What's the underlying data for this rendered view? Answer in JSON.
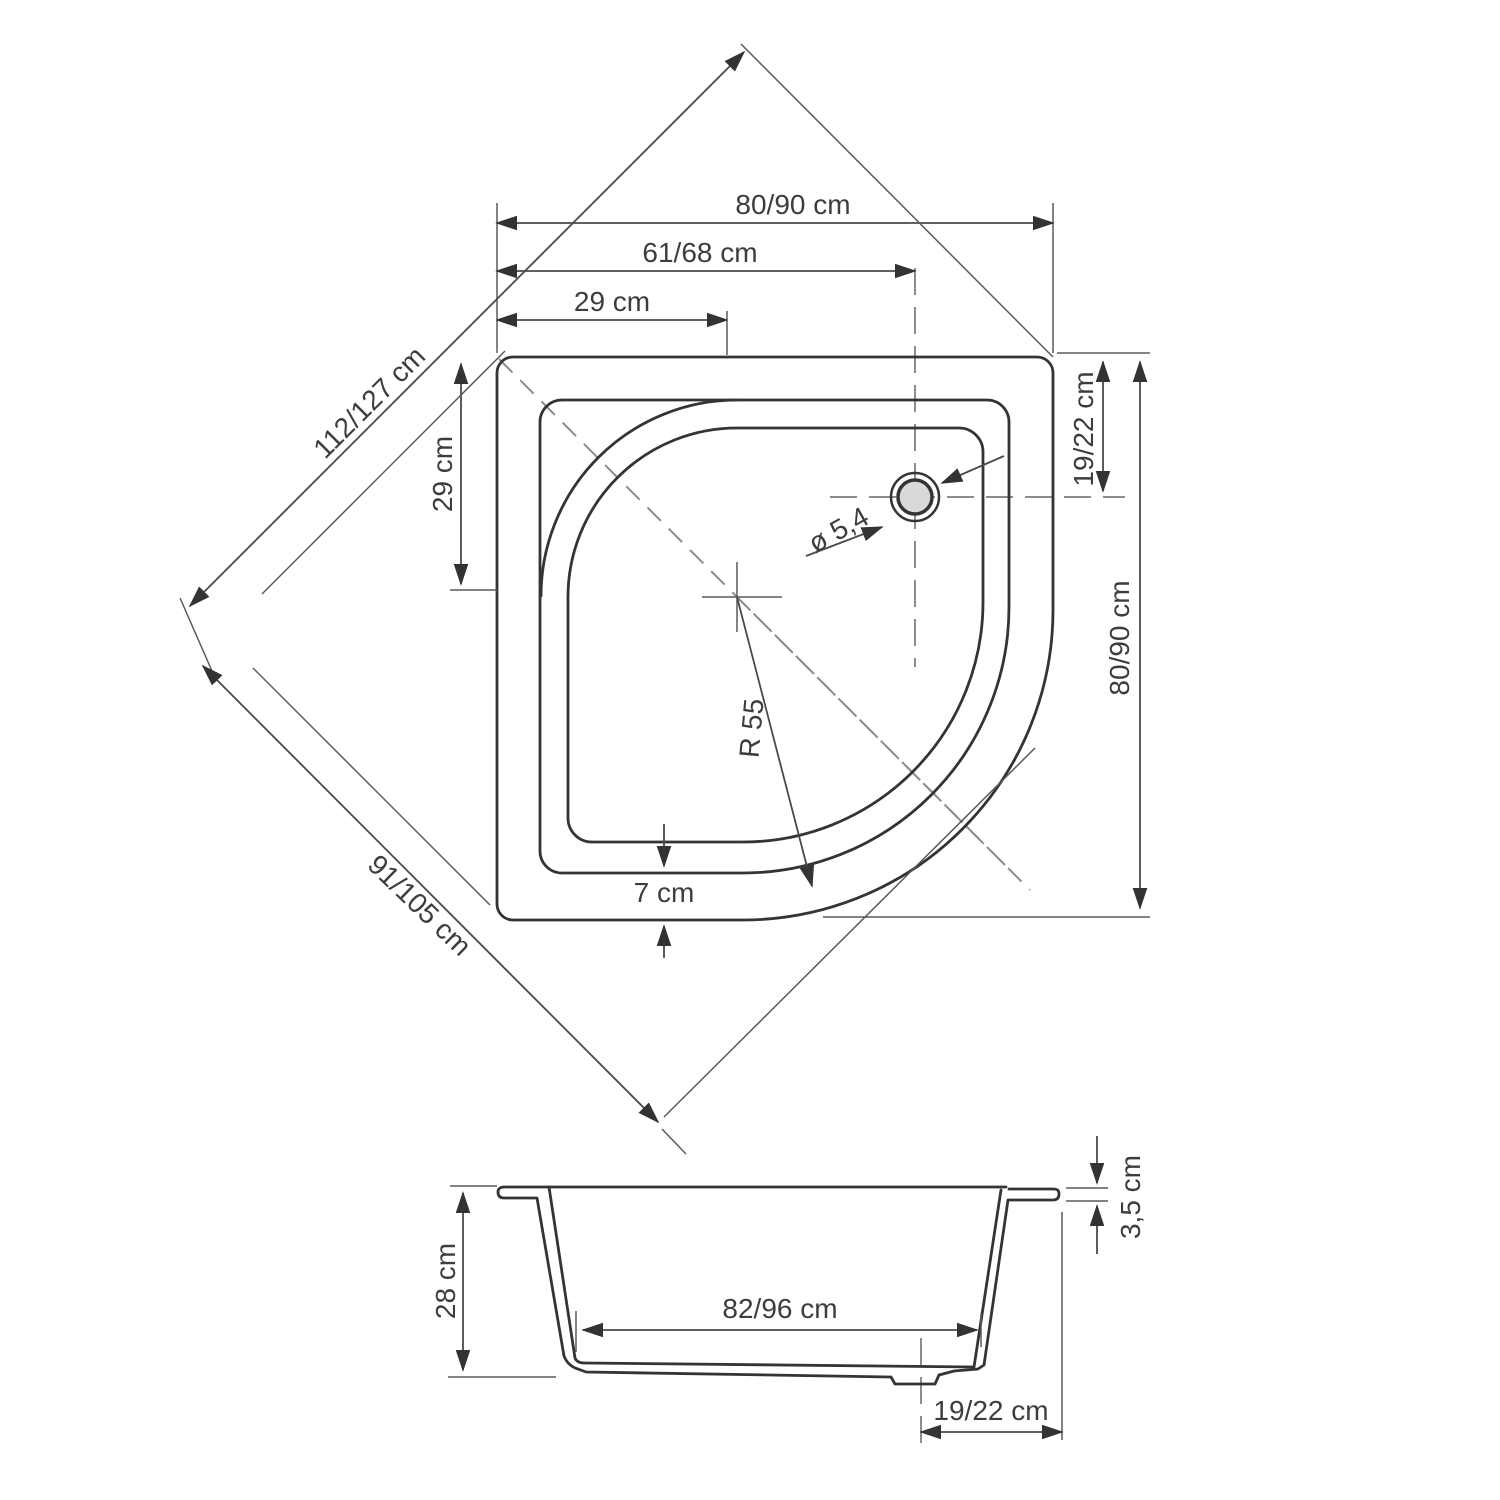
{
  "plan": {
    "width_top": "80/90 cm",
    "width_inner": "61/68 cm",
    "offset_horizontal": "29 cm",
    "offset_vertical": "29 cm",
    "diagonal_back": "112/127 cm",
    "diagonal_front": "91/105 cm",
    "drain_offset_top": "19/22 cm",
    "depth_right": "80/90 cm",
    "drain_diameter": "ø 5,4",
    "front_radius": "R 55",
    "rim_width": "7 cm"
  },
  "section": {
    "height": "28 cm",
    "floor_width": "82/96 cm",
    "drain_offset": "19/22 cm",
    "rim_height": "3,5 cm"
  },
  "colors": {
    "line": "#343434",
    "dimension": "#4a4a4a",
    "dashed": "#8c8c8c",
    "drain_fill": "#d9d9d9",
    "background": "#ffffff"
  }
}
